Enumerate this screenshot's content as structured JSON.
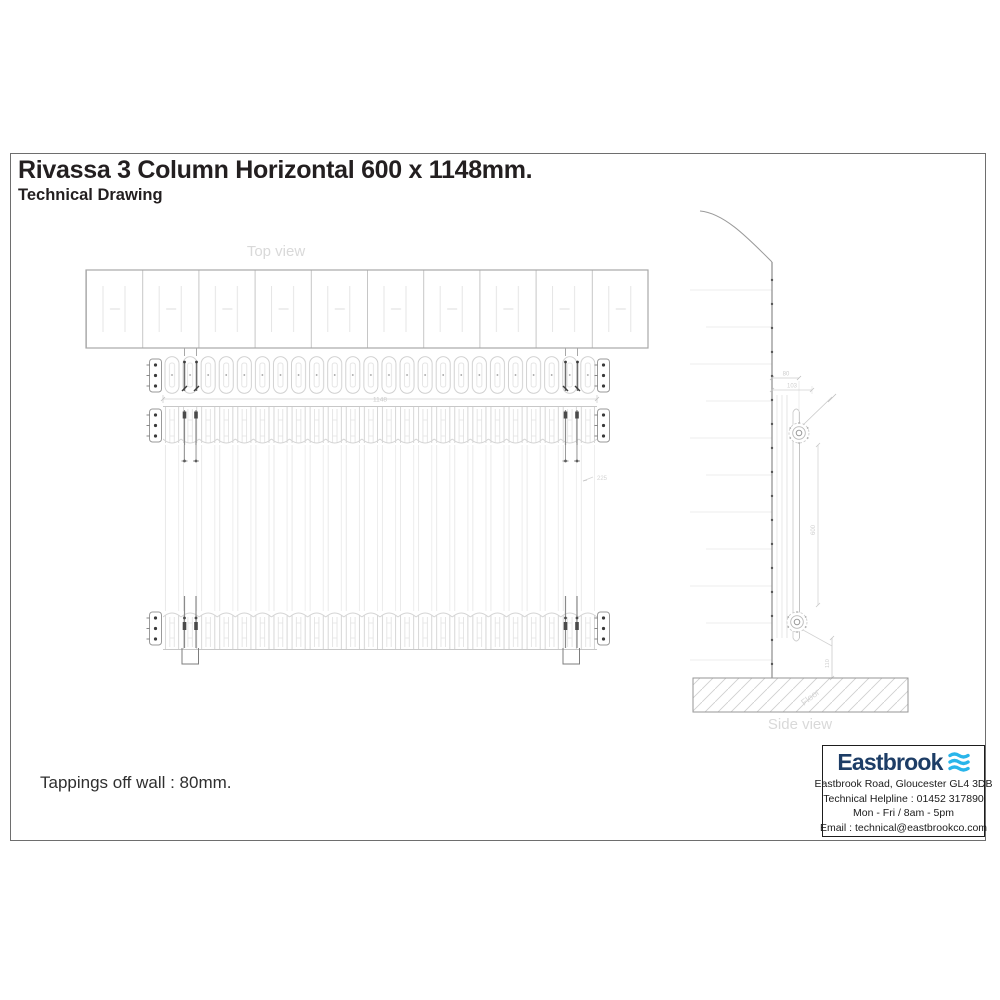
{
  "header": {
    "title": "Rivassa 3 Column Horizontal 600 x 1148mm.",
    "subtitle": "Technical Drawing"
  },
  "note": "Tappings off wall : 80mm.",
  "views": {
    "top_label": "Top view",
    "side_label": "Side view",
    "floor_label": "Floor"
  },
  "dimensions": {
    "overall_width": "1148",
    "tapping_off_wall": "80",
    "depth": "103",
    "overall_height": "600",
    "floor_clearance": "110",
    "side_note": "225"
  },
  "company": {
    "name": "Eastbrook",
    "address": "Eastbrook Road, Gloucester GL4 3DB",
    "helpline": "Technical Helpline : 01452 317890",
    "hours": "Mon - Fri / 8am - 5pm",
    "email": "Email : technical@eastbrookco.com",
    "brand_color": "#1d3d66",
    "icon_color": "#29b5ea"
  }
}
